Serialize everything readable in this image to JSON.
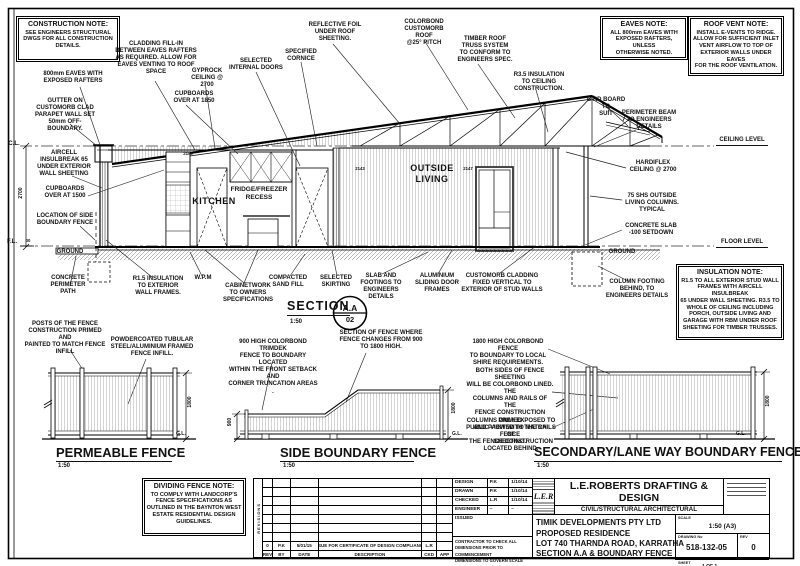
{
  "notes": {
    "construction": {
      "title": "CONSTRUCTION NOTE:",
      "body": "SEE ENGINEERS STRUCTURAL\nDWGS FOR ALL CONSTRUCTION\nDETAILS."
    },
    "eaves": {
      "title": "EAVES NOTE:",
      "body": "ALL 800mm EAVES WITH\nEXPOSED RAFTERS, UNLESS\nOTHERWISE NOTED."
    },
    "roof_vent": {
      "title": "ROOF VENT NOTE:",
      "body": "INSTALL E-VENTS TO RIDGE.\nALLOW FOR SUFFICIENT INLET\nVENT AIRFLOW TO TOP OF\nEXTERIOR WALLS UNDER EAVES\nFOR THE ROOF VENTILATION."
    },
    "insulation": {
      "title": "INSULATION NOTE:",
      "body": "R1.5 TO ALL EXTERIOR STUD WALL\nFRAMES WITH AIRCELL INSULBREAK\n65 UNDER WALL SHEETING. R3.5 TO\nWHOLE OF CEILING INCLUDING\nPORCH, OUTSIDE LIVING AND\nGARAGE WITH RBM UNDER ROOF\nSHEETING FOR TIMBER TRUSSES."
    },
    "dividing_fence": {
      "title": "DIVIDING FENCE NOTE:",
      "body": "TO COMPLY WITH LANDCORP'S\nFENCE SPECIFICATIONS AS\nOUTLINED IN THE BAYNTON WEST\nESTATE RESIDENTIAL DESIGN\nGUIDELINES."
    }
  },
  "labels": {
    "cladding_fill": "CLADDING FILL-IN\nBETWEEN EAVES RAFTERS\nAS REQUIRED. ALLOW FOR\nEAVES VENTING TO ROOF\nSPACE",
    "eaves800": "800mm EAVES WITH\nEXPOSED RAFTERS",
    "gutter": "GUTTER ON\nCUSTOMORB CLAD\nPARAPET WALL SET\n50mm OFF-\nBOUNDARY.",
    "gyprock": "GYPROCK\nCEILING @ 2700",
    "cupboards1850": "CUPBOARDS\nOVER AT 1850",
    "internal_doors": "SELECTED\nINTERNAL DOORS",
    "cornice": "SPECIFIED\nCORNICE",
    "reflective_foil": "REFLECTIVE FOIL\nUNDER ROOF\nSHEETING.",
    "colorbond_roof": "COLORBOND\nCUSTOMORB ROOF\n@25° PITCH",
    "truss": "TIMBER ROOF\nTRUSS SYSTEM\nTO CONFORM TO\nENGINEERS SPEC.",
    "r35": "R3.5 INSULATION\nTO CEILING\nCONSTRUCTION.",
    "bird_board": "BIRD BOARD TO\nSUIT",
    "perimeter_beam": "PERIMETER BEAM\nTO ENGINEERS\nDETAILS",
    "ceiling_level": "CEILING LEVEL",
    "hardiflex": "HARDIFLEX\nCEILING @ 2700",
    "shs": "75 SHS OUTSIDE\nLIVING COLUMNS.\nTYPICAL",
    "slab_setdown": "CONCRETE SLAB\n-100 SETDOWN",
    "floor_level": "FLOOR LEVEL",
    "ground_left": "GROUND",
    "ground_right": "GROUND",
    "cl": "C.L.",
    "fl": "F.L.",
    "fl_val": "00",
    "aircell": "AIRCELL\nINSULBREAK 65\nUNDER EXTERIOR\nWALL SHEETING",
    "cupboards1500": "CUPBOARDS\nOVER AT 1500",
    "fence_location": "LOCATION OF SIDE\nBOUNDARY FENCE",
    "dim2700": "2700",
    "concrete_path": "CONCRETE\nPERIMETER\nPATH",
    "r15": "R1.5 INSULATION\nTO EXTERIOR\nWALL FRAMES.",
    "wpm": "W.P.M",
    "cabinetwork": "CABINETWORK\nTO OWNERS\nSPECIFICATIONS",
    "sand_fill": "COMPACTED\nSAND FILL",
    "skirting": "SELECTED\nSKIRTING",
    "slab_footings": "SLAB AND\nFOOTINGS TO\nENGINEERS\nDETAILS",
    "alum_doors": "ALUMINIUM\nSLIDING DOOR\nFRAMES",
    "customorb_clad": "CUSTOMORB CLADDING\nFIXED VERTICAL TO\nEXTERIOR OF STUD WALLS",
    "column_footing": "COLUMN FOOTING\nBEHIND, TO\nENGINEERS DETAILS",
    "kitchen": "KITCHEN",
    "fridge": "FRIDGE/FREEZER\nRECESS",
    "outside_living": "OUTSIDE\nLIVING",
    "posts_fence": "POSTS OF THE FENCE\nCONSTRUCTION PRIMED AND\nPAINTED TO MATCH FENCE\nINFILL",
    "powdercoated": "POWDERCOATED TUBULAR\nSTEEL/ALUMINIUM FRAMED\nFENCE INFILL.",
    "trimdek900": "900 HIGH COLORBOND TRIMDEK\nFENCE TO BOUNDARY LOCATED\nWITHIN THE FRONT SETBACK AND\nCORNER TRUNCATION AREAS .",
    "fence_change": "SECTION OF FENCE WHERE\nFENCE CHANGES FROM 900\nTO 1800 HIGH.",
    "fence1800": "1800 HIGH COLORBOND FENCE\nTO BOUNDARY TO LOCAL\nSHIRE REQUIREMENTS.",
    "both_sides": "BOTH SIDES OF FENCE SHEETING\nWILL BE COLORBOND LINED. THE\nCOLUMNS AND RAILS OF THE\nFENCE CONSTRUCTION PRIMED\nAND PAINTED TO MATCH FENCE\nSHEETING.",
    "columns_exposed": "COLUMNS ONLY EXPOSED TO\nPUBLIC VIEW WITH THE RAILS OF\nTHE FENCE CONSTRUCTION\nLOCATED BEHIND.",
    "d2150": "2150",
    "d2143": "2143",
    "d2147": "2147"
  },
  "section": {
    "title": "SECTION",
    "scale": "1:50",
    "detail": "A.A",
    "number": "02"
  },
  "fences": [
    {
      "title": "PERMEABLE FENCE",
      "scale": "1:50",
      "height": "1800",
      "gl": "G.L."
    },
    {
      "title": "SIDE BOUNDARY FENCE",
      "scale": "1:50",
      "height_left": "900",
      "height": "1800",
      "gl": "G.L."
    },
    {
      "title": "SECONDARY/LANE WAY BOUNDARY FENCE",
      "scale": "1:50",
      "height": "1800",
      "gl": "G.L."
    }
  ],
  "titleblock": {
    "revisions_label": "REVISIONS",
    "rev_entry": [
      "0",
      "P.K",
      "5/01/15",
      "ISSUE FOR CERTIFICATE OF DESIGN COMPLIANCE",
      "L.R",
      ""
    ],
    "rev_header": [
      "REV",
      "BY",
      "DATE",
      "DESCRIPTION",
      "CKD",
      "APP"
    ],
    "signoff": [
      [
        "DESIGN",
        "P.K",
        "1/10/14"
      ],
      [
        "DRAWN",
        "P.K",
        "1/10/14"
      ],
      [
        "CHECKED",
        "L.R",
        "1/10/14"
      ],
      [
        "ENGINEER",
        "–",
        "–"
      ]
    ],
    "issued_label": "ISSUED",
    "note": "CONTRACTOR TO CHECK ALL\nDIMENSIONS PRIOR TO COMMENCEMENT\nDIMENSIONS TO GOVERN SCALE",
    "company": {
      "logo": "L.E.R",
      "name": "L.E.ROBERTS DRAFTING & DESIGN",
      "tagline": "CIVIL/STRUCTURAL ARCHITECTURAL"
    },
    "project": [
      "TIMIK DEVELOPMENTS PTY LTD",
      "PROPOSED RESIDENCE",
      "LOT 740 THARNDA ROAD, KARRATHA",
      "SECTION A.A & BOUNDARY FENCE"
    ],
    "meta": {
      "scale_label": "SCALE",
      "scale": "1:50 (A3)",
      "drawing_label": "DRAWING No",
      "drawing_no": "518-132-05",
      "rev_label": "REV",
      "rev": "0",
      "sheet_label": "SHEET",
      "sheet": "1 OF 1"
    }
  },
  "colors": {
    "line": "#111111",
    "hatch_light": "#aaaaaa",
    "hatch_dark": "#555555"
  }
}
